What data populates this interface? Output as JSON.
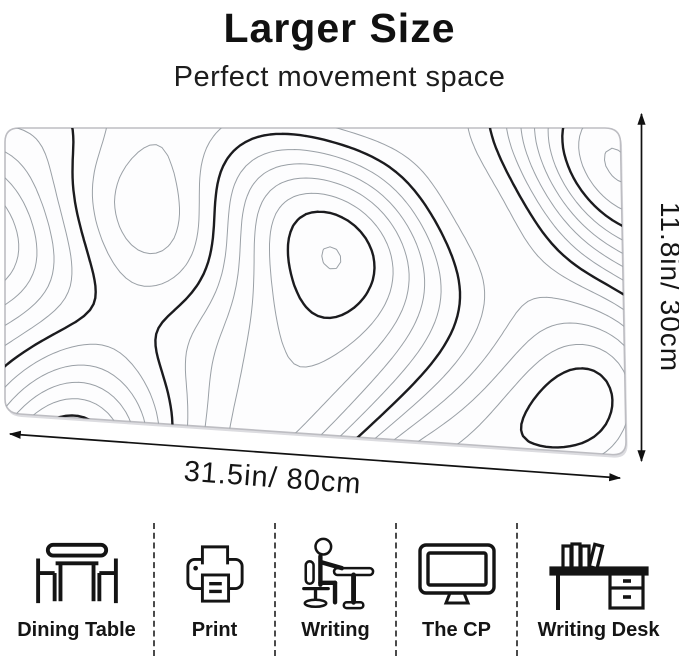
{
  "header": {
    "title": "Larger Size",
    "subtitle": "Perfect movement space"
  },
  "dimensions": {
    "height_label": "11.8in/ 30cm",
    "width_label": "31.5in/ 80cm"
  },
  "features": [
    {
      "icon": "dining-table-icon",
      "label": "Dining Table"
    },
    {
      "icon": "printer-icon",
      "label": "Print"
    },
    {
      "icon": "writing-person-icon",
      "label": "Writing"
    },
    {
      "icon": "computer-icon",
      "label": "The CP"
    },
    {
      "icon": "writing-desk-icon",
      "label": "Writing Desk"
    }
  ],
  "colors": {
    "text": "#111111",
    "contour_thin": "#9aa0a6",
    "contour_thick": "#1b1b1e",
    "pad_background": "#fdfdfe",
    "pad_border": "#bdbdc2",
    "divider": "#4a4a4a"
  }
}
